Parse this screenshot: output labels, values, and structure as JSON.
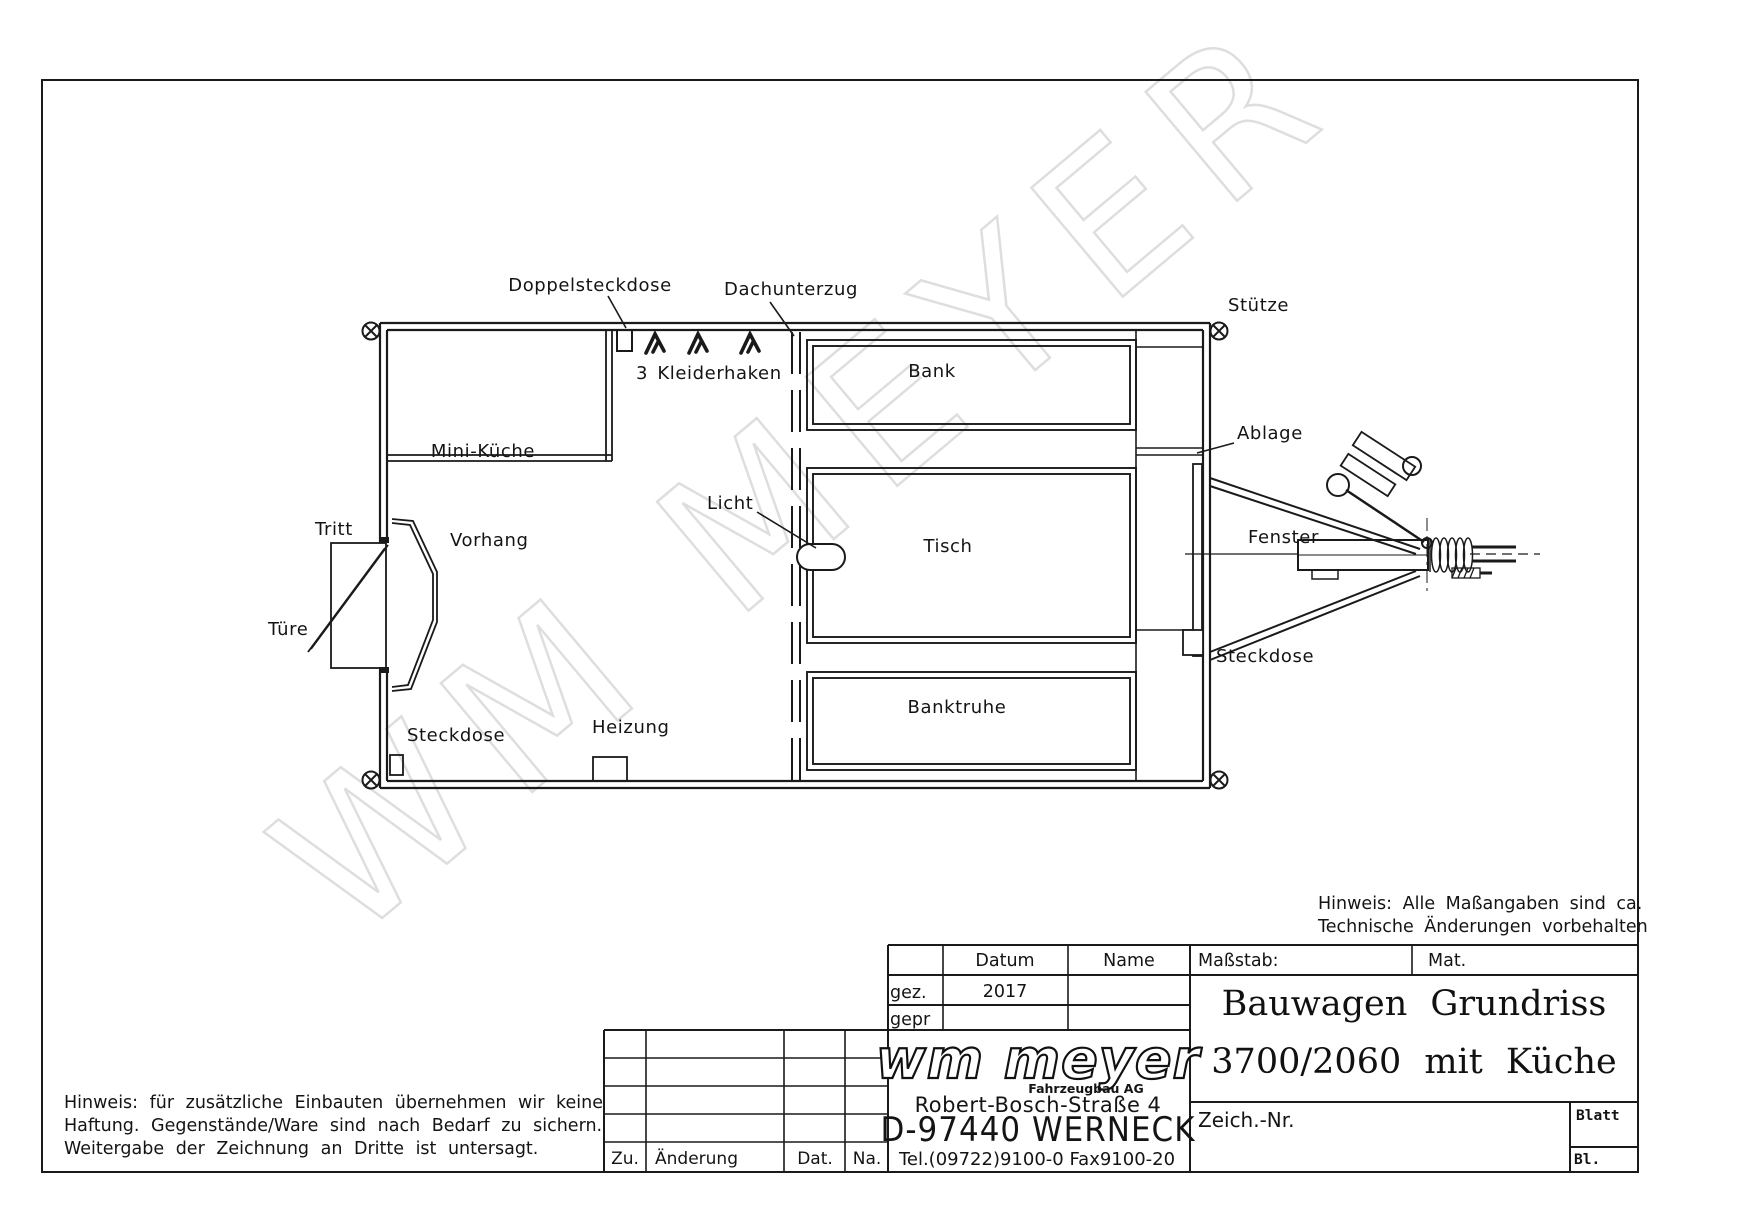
{
  "watermark": "WM MEYER",
  "plan": {
    "labels": {
      "doppelsteckdose": "Doppelsteckdose",
      "dachunterzug": "Dachunterzug",
      "stuetze": "Stütze",
      "kleiderhaken": "3 Kleiderhaken",
      "bank": "Bank",
      "ablage": "Ablage",
      "mini_kueche": "Mini-Küche",
      "licht": "Licht",
      "tisch": "Tisch",
      "fenster": "Fenster",
      "tritt": "Tritt",
      "vorhang": "Vorhang",
      "tuere": "Türe",
      "steckdose_left": "Steckdose",
      "heizung": "Heizung",
      "banktruhe": "Banktruhe",
      "steckdose_right": "Steckdose"
    }
  },
  "notes": {
    "top_right": [
      "Hinweis: Alle Maßangaben sind ca.",
      "Technische Änderungen vorbehalten"
    ],
    "bottom_left": [
      "Hinweis: für zusätzliche Einbauten übernehmen wir keine",
      "Haftung. Gegenstände/Ware sind nach Bedarf zu sichern.",
      "Weitergabe der Zeichnung an Dritte ist untersagt."
    ]
  },
  "title_block": {
    "header": {
      "datum": "Datum",
      "name": "Name",
      "massstab": "Maßstab:",
      "mat": "Mat."
    },
    "gez_label": "gez.",
    "gez_datum": "2017",
    "gepr_label": "gepr",
    "title_line1": "Bauwagen Grundriss",
    "title_line2": "3700/2060 mit Küche",
    "logo": {
      "name": "wm meyer",
      "sub": "Fahrzeugbau AG",
      "address": "Robert-Bosch-Straße 4",
      "city": "D-97440 WERNECK",
      "phone": "Tel.(09722)9100-0   Fax9100-20"
    },
    "revision": {
      "zu": "Zu.",
      "aenderung": "Änderung",
      "dat": "Dat.",
      "na": "Na."
    },
    "zeich_nr": "Zeich.-Nr.",
    "blatt": "Blatt",
    "bl": "Bl."
  },
  "colors": {
    "line": "#1a1a1a",
    "watermark": "#dedede",
    "background": "#ffffff"
  }
}
